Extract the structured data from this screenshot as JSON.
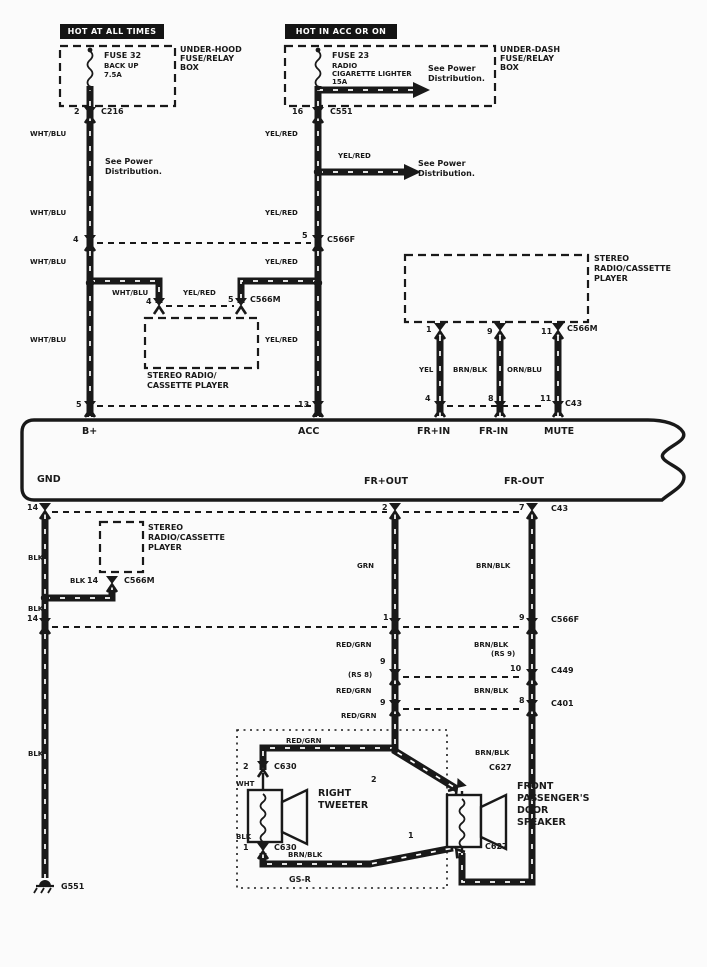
{
  "wire_colors": {
    "wht_blu": "WHT/BLU",
    "yel_red": "YEL/RED",
    "blk": "BLK",
    "grn": "GRN",
    "red_grn": "RED/GRN",
    "brn_blk": "BRN/BLK",
    "yel": "YEL",
    "orn_blu": "ORN/BLU",
    "wht": "WHT"
  },
  "connectors": {
    "c216": "C216",
    "c551": "C551",
    "c566f": "C566F",
    "c566m": "C566M",
    "c43": "C43",
    "c449": "C449",
    "c401": "C401",
    "c630": "C630",
    "c627": "C627",
    "g551": "G551"
  },
  "power_left": {
    "header": "HOT AT ALL TIMES",
    "fuse_name": "FUSE 32",
    "fuse_desc": "BACK UP",
    "fuse_rating": "7.5A",
    "box_l1": "UNDER-HOOD",
    "box_l2": "FUSE/RELAY",
    "box_l3": "BOX",
    "pin": "2",
    "see_power_l1": "See Power",
    "see_power_l2": "Distribution.",
    "pin_c566f": "4",
    "pin_bus": "5"
  },
  "power_right": {
    "header": "HOT IN ACC OR ON",
    "fuse_name": "FUSE 23",
    "fuse_desc_l1": "RADIO",
    "fuse_desc_l2": "CIGARETTE LIGHTER",
    "fuse_rating": "15A",
    "see_power_l1": "See Power",
    "see_power_l2": "Distribution.",
    "box_l1": "UNDER-DASH",
    "box_l2": "FUSE/RELAY",
    "box_l3": "BOX",
    "pin": "16",
    "pin_c566f": "5",
    "pin_bus": "13"
  },
  "branch": {
    "pin_wht": "4",
    "pin_yel": "5"
  },
  "stereo_box": {
    "l1": "STEREO",
    "l2": "RADIO/CASSETTE",
    "l3": "PLAYER",
    "two_l1": "STEREO RADIO/",
    "two_l2": "CASSETTE PLAYER"
  },
  "stereo_right": {
    "pins": [
      "1",
      "9",
      "11"
    ],
    "bus_pins": [
      "4",
      "8",
      "11"
    ]
  },
  "radio": {
    "b_plus": "B+",
    "acc": "ACC",
    "fr_in_pos": "FR+IN",
    "fr_in_neg": "FR-IN",
    "mute": "MUTE",
    "gnd": "GND",
    "fr_out_pos": "FR+OUT",
    "fr_out_neg": "FR-OUT"
  },
  "rows": {
    "c43": {
      "left": "14",
      "mid": "2",
      "right": "7"
    },
    "c566f": {
      "left": "14",
      "mid": "1",
      "right": "9"
    },
    "c449": {
      "mid": "9",
      "right": "10",
      "rs_mid": "(RS 8)",
      "rs_right": "(RS 9)"
    },
    "c401": {
      "mid": "9",
      "right": "8"
    }
  },
  "ground_branch": {
    "pin": "14"
  },
  "speakers": {
    "tweeter": {
      "pin_top": "2",
      "pin_bot": "1",
      "l1": "RIGHT",
      "l2": "TWEETER"
    },
    "door": {
      "pin_top": "2",
      "pin_bot": "1",
      "l1": "FRONT",
      "l2": "PASSENGER'S",
      "l3": "DOOR",
      "l4": "SPEAKER"
    },
    "gsr": "GS-R"
  }
}
